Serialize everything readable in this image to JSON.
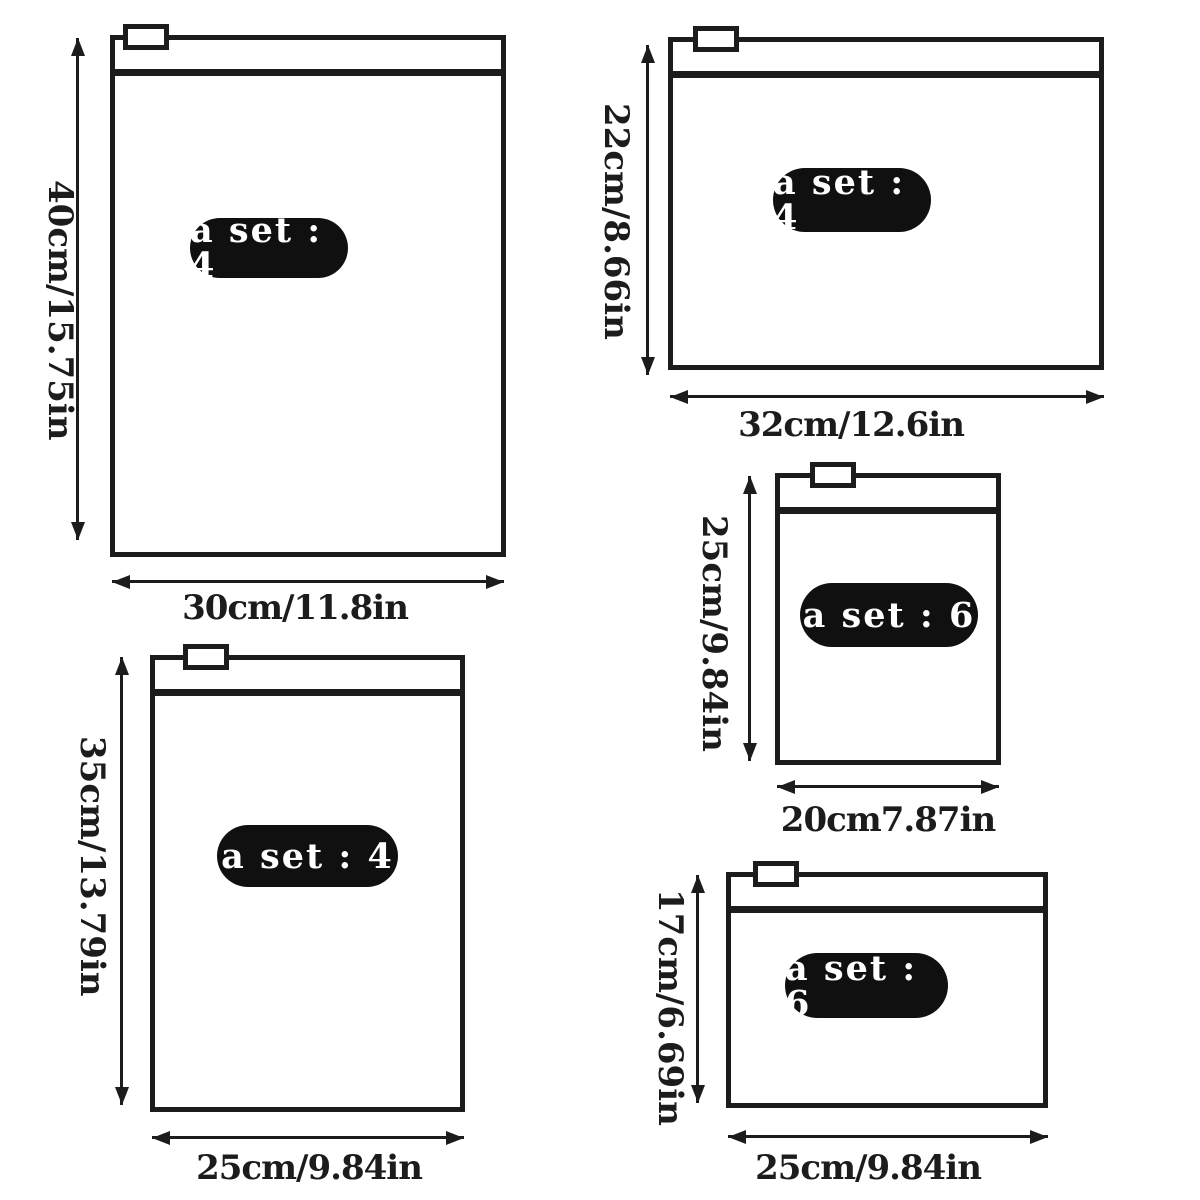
{
  "colors": {
    "ink": "#1c1c1c",
    "background": "#ffffff",
    "pill_bg": "#101010",
    "pill_text": "#ffffff"
  },
  "bags": [
    {
      "size_name": "40cm x 30cm",
      "set_label": "a set : 4",
      "height_label": "40cm/15.75in",
      "width_label": "30cm/11.8in"
    },
    {
      "size_name": "22cm x 32cm",
      "set_label": "a set : 4",
      "height_label": "22cm/8.66in",
      "width_label": "32cm/12.6in"
    },
    {
      "size_name": "25cm x 20cm",
      "set_label": "a set : 6",
      "height_label": "25cm/9.84in",
      "width_label": "20cm7.87in"
    },
    {
      "size_name": "35cm x 25cm",
      "set_label": "a set : 4",
      "height_label": "35cm/13.79in",
      "width_label": "25cm/9.84in"
    },
    {
      "size_name": "17cm x 25cm",
      "set_label": "a set : 6",
      "height_label": "17cm/6.69in",
      "width_label": "25cm/9.84in"
    }
  ]
}
